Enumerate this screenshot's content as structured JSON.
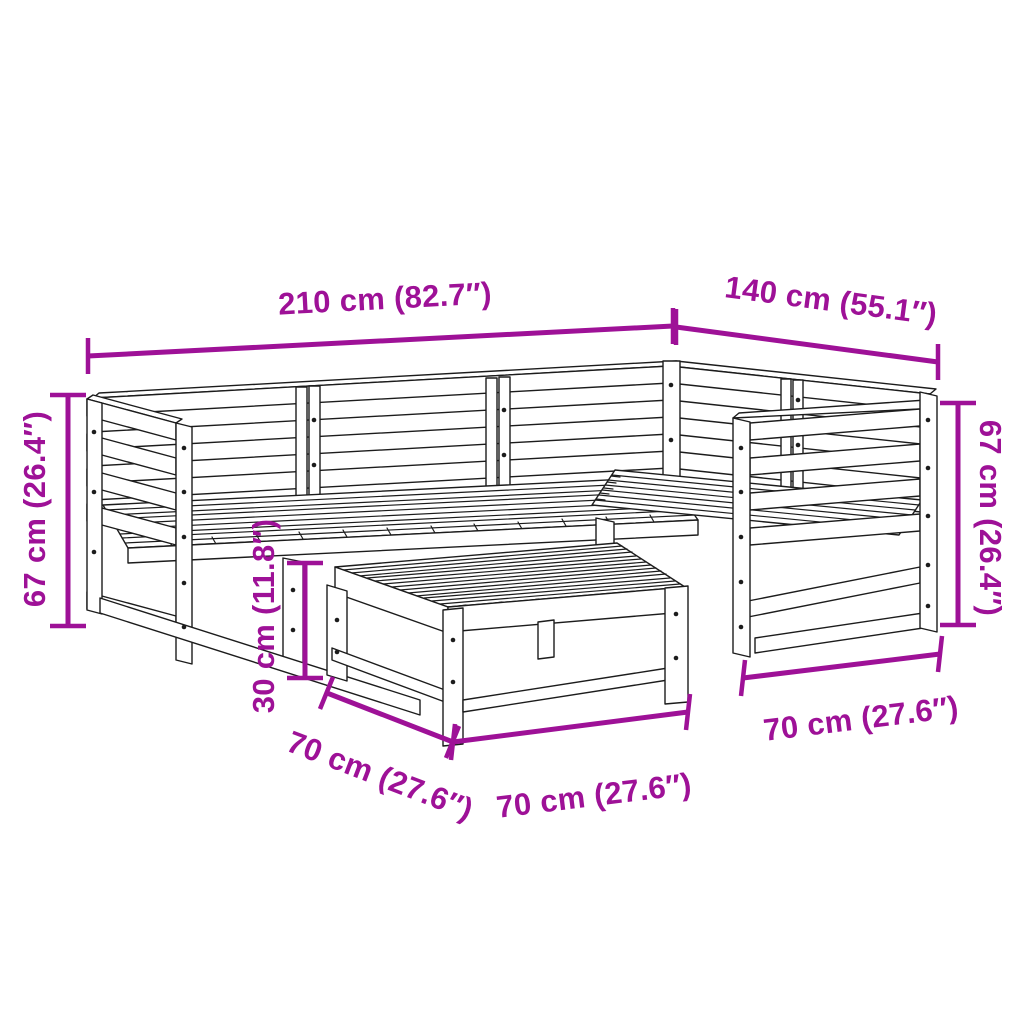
{
  "colors": {
    "accent": "#9e1197",
    "ink": "#1c1c1c",
    "background": "#ffffff"
  },
  "illustration": {
    "subject": "Isometric black line drawing of a 5-piece wooden garden lounge set: L-shaped slatted corner sofa with left and right arms, plus a square slatted footstool table in front"
  },
  "dimensions": {
    "total_width": {
      "label": "210 cm (82.7″)"
    },
    "total_depth": {
      "label": "140 cm (55.1″)"
    },
    "sofa_height_left": {
      "label": "67 cm (26.4″)"
    },
    "sofa_height_right": {
      "label": "67 cm (26.4″)"
    },
    "table_height": {
      "label": "30 cm (11.8″)"
    },
    "table_depth": {
      "label": "70 cm (27.6″)"
    },
    "table_width": {
      "label": "70 cm (27.6″)"
    },
    "module_depth": {
      "label": "70 cm (27.6″)"
    }
  }
}
